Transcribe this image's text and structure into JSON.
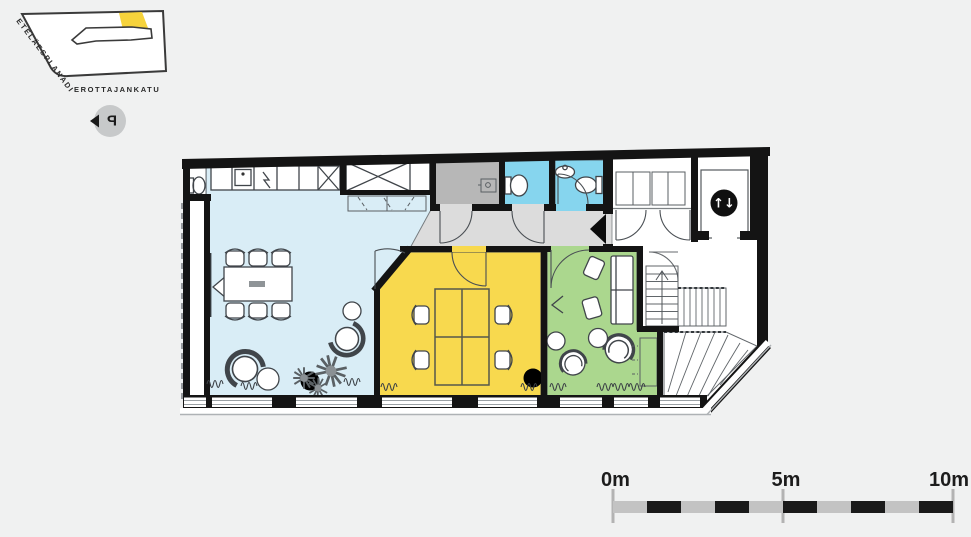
{
  "site_map": {
    "street_primary": "ETELÄESPLANADI",
    "street_secondary": "EROTTAJANKATU",
    "parking_label": "P",
    "block_fill": "#ffffff",
    "block_outline": "#3a3a3a",
    "highlight_color": "#f6d33c"
  },
  "floor_plan": {
    "colors": {
      "lounge_kitchen": "#d9edf6",
      "office": "#f8d94e",
      "green_lounge": "#abd78e",
      "bathroom": "#86d5ee",
      "storage": "#b7b7b7",
      "corridor": "#dcdcdc",
      "wall": "#141414",
      "column": "#000000"
    },
    "elevator_icon": "↑↓",
    "icons": {
      "entrance_marker": "left-triangle",
      "elevator": "up-down-arrows"
    }
  },
  "scale_bar": {
    "labels": [
      "0m",
      "5m",
      "10m"
    ],
    "tick_color": "#b3b3b3",
    "bar_gray": "#c3c3c3",
    "bar_black": "#1a1a1a",
    "meters_total": 10
  }
}
